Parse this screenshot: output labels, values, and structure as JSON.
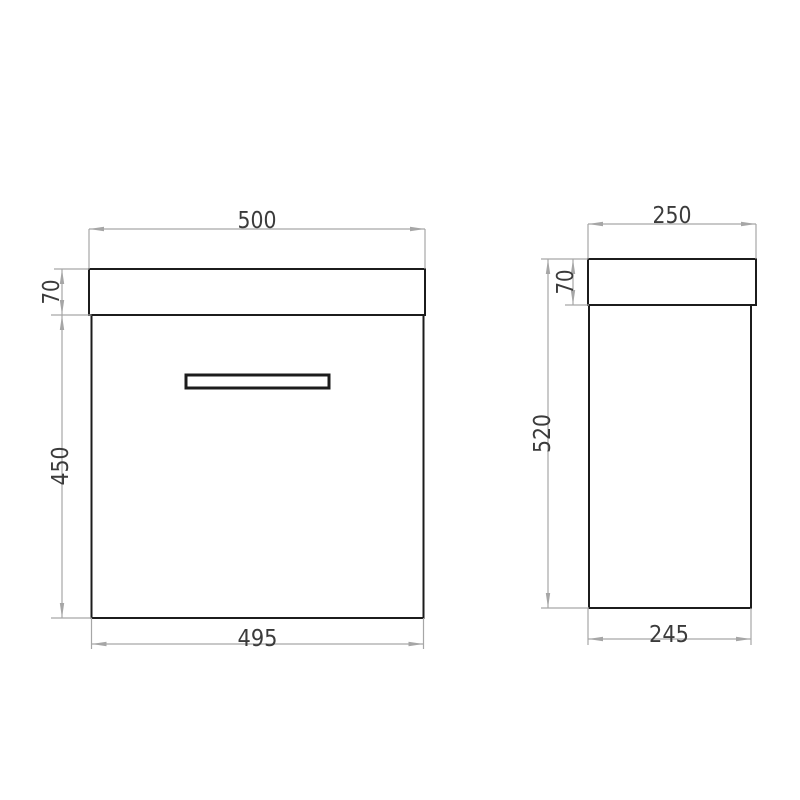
{
  "drawing": {
    "views": {
      "front": {
        "name": "front-view",
        "top_width": "500",
        "worktop_height": "70",
        "body_height": "450",
        "bottom_width": "495"
      },
      "side": {
        "name": "side-view",
        "top_depth": "250",
        "worktop_height": "70",
        "total_height": "520",
        "bottom_depth": "245"
      }
    },
    "colors": {
      "outline": "#1c1c1c",
      "dim_line": "#a6a6a6",
      "dim_text": "#3b3b3b",
      "background": "#ffffff"
    }
  }
}
